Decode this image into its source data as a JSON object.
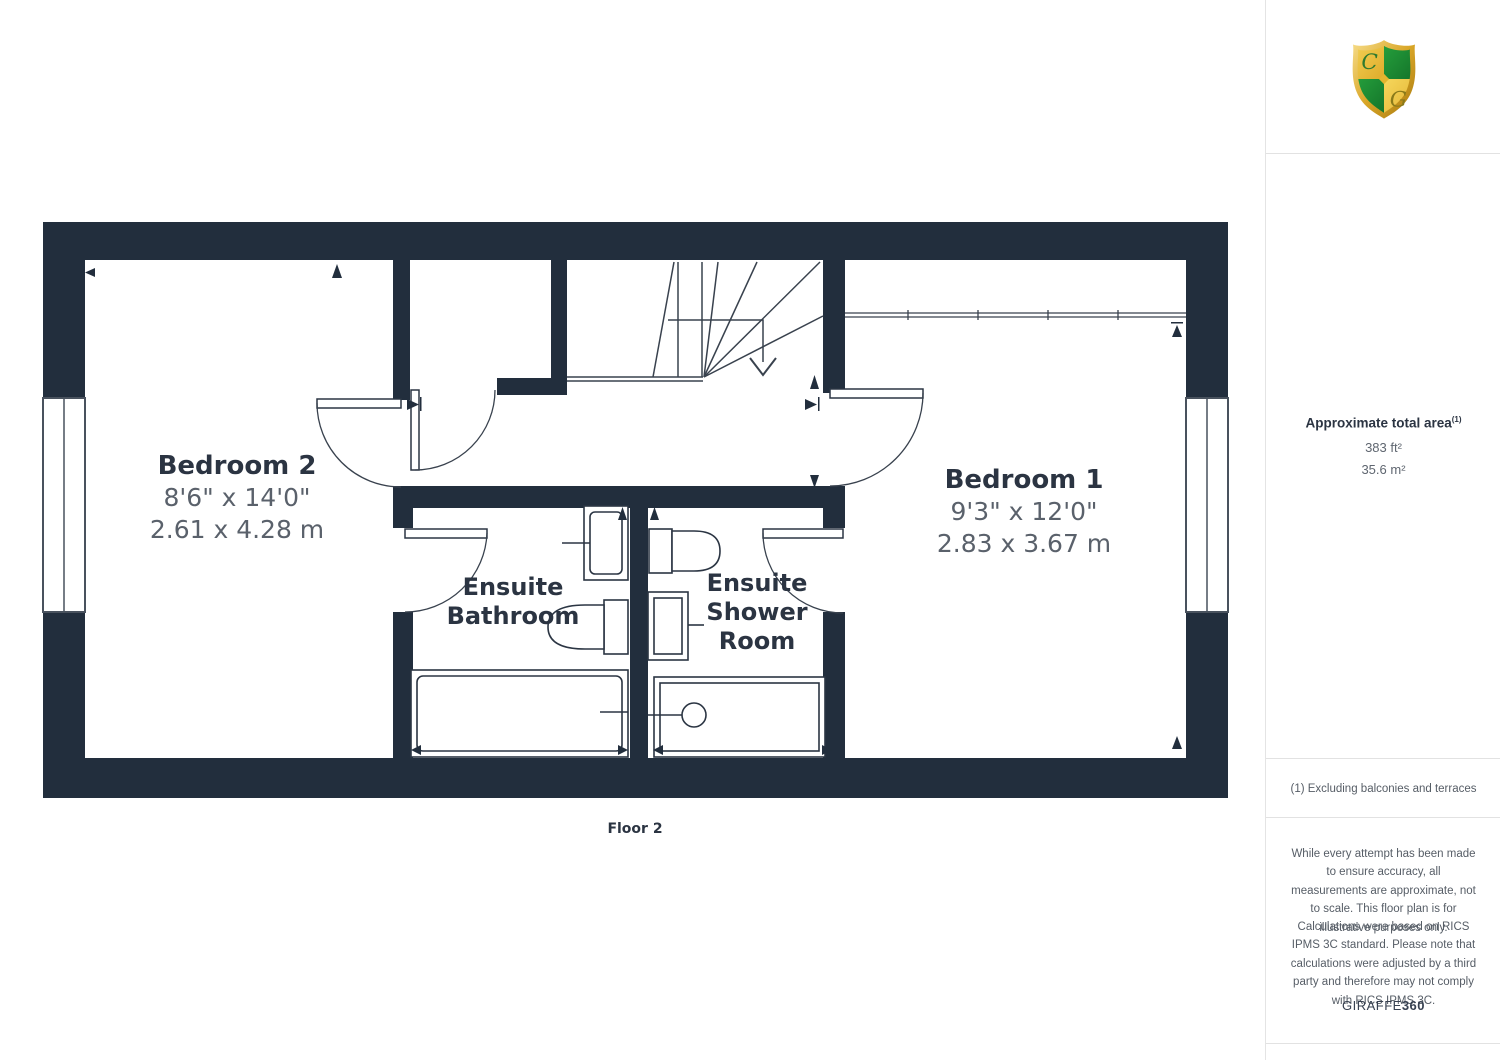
{
  "plan": {
    "floor_label": "Floor 2",
    "rooms": {
      "bedroom2": {
        "name": "Bedroom 2",
        "dims_imperial": "8'6\" x 14'0\"",
        "dims_metric": "2.61 x 4.28 m"
      },
      "bedroom1": {
        "name": "Bedroom 1",
        "dims_imperial": "9'3\" x 12'0\"",
        "dims_metric": "2.83 x 3.67 m"
      },
      "ensuite_bathroom": {
        "line1": "Ensuite",
        "line2": "Bathroom"
      },
      "ensuite_shower": {
        "line1": "Ensuite",
        "line2": "Shower",
        "line3": "Room"
      }
    }
  },
  "sidebar": {
    "area_title": "Approximate total area",
    "area_superscript": "(1)",
    "area_imperial": "383 ft²",
    "area_metric": "35.6 m²",
    "footnote": "(1) Excluding balconies and terraces",
    "disclaimer_1": "While every attempt has been made to ensure accuracy, all measurements are approximate, not to scale. This floor plan is for illustrative purposes only.",
    "disclaimer_2": "Calculations were based on RICS IPMS 3C standard. Please note that calculations were adjusted by a third party and therefore may not comply with RICS IPMS 3C.",
    "brand": "GIRAFFE",
    "brand_suffix": "360",
    "logo": {
      "letter_c": "C",
      "letter_g": "G"
    }
  },
  "colors": {
    "wall": "#222e3d",
    "thin_line": "#39424e",
    "room_title": "#2b3442",
    "room_dims": "#5a616b",
    "sidebar_text": "#565d66",
    "logo_gold": "#d9a627",
    "logo_green": "#1f8c33"
  }
}
